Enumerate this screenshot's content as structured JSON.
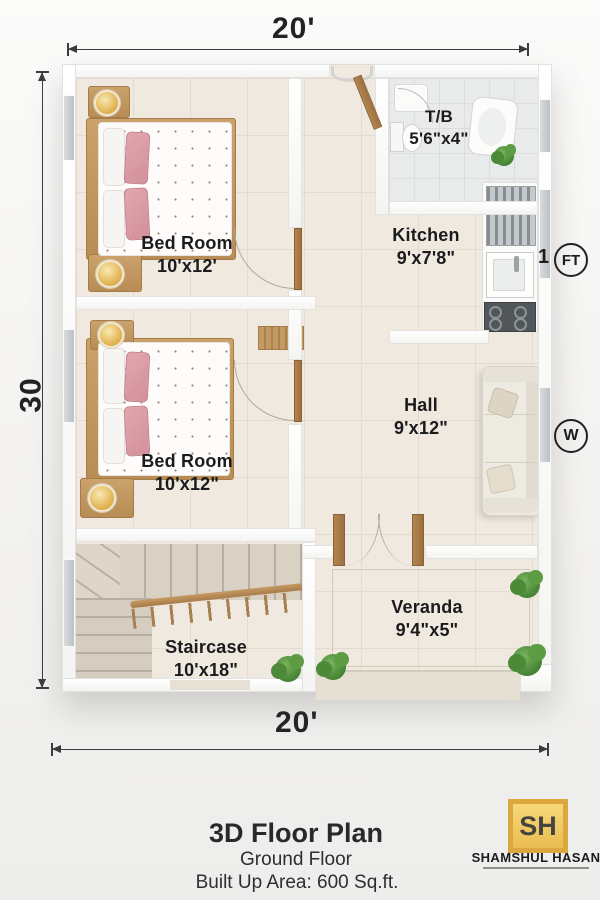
{
  "dimensions": {
    "top": "20'",
    "bottom": "20'",
    "left": "30"
  },
  "rooms": [
    {
      "name": "Bed Room",
      "size": "10'x12'"
    },
    {
      "name": "Bed Room",
      "size": "10'x12\""
    },
    {
      "name": "T/B",
      "size": "5'6\"x4\""
    },
    {
      "name": "Kitchen",
      "size": "9'x7'8\""
    },
    {
      "name": "Hall",
      "size": "9'x12\""
    },
    {
      "name": "Staircase",
      "size": "10'x18\""
    },
    {
      "name": "Veranda",
      "size": "9'4\"x5\""
    }
  ],
  "annotations": {
    "scale_number": "1",
    "scale_unit": "FT",
    "compass_west": "W"
  },
  "title": {
    "main": "3D Floor Plan",
    "floor": "Ground Floor",
    "area": "Built Up Area: 600 Sq.ft."
  },
  "brand": {
    "initials": "SH",
    "name": "SHAMSHUL HASAN"
  },
  "colors": {
    "wood": "#b98d5a",
    "pink": "#db9aa3",
    "plant": "#4e8a38",
    "gold": "#e8b94d",
    "floor": "#efe9e0",
    "wall": "#ffffff",
    "text": "#1d1d1f"
  }
}
